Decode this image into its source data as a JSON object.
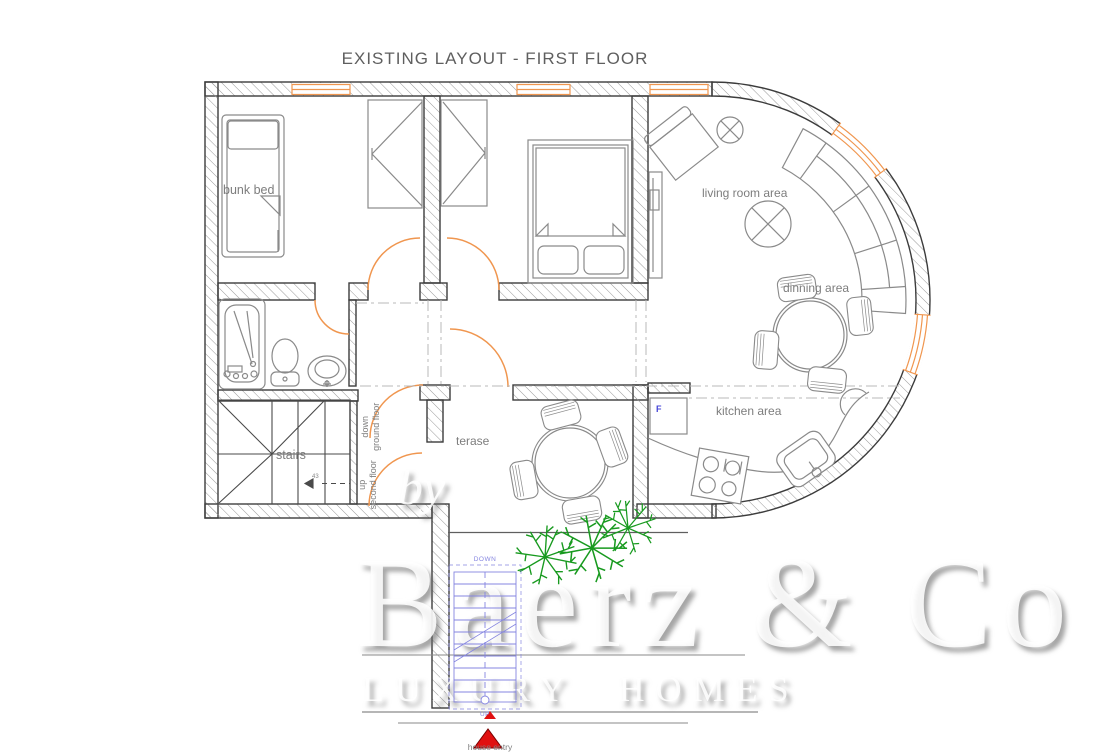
{
  "title": "EXISTING LAYOUT - FIRST FLOOR",
  "labels": {
    "bunk_bed": "bunk bed",
    "living_room": "living room area",
    "dining": "dinning area",
    "kitchen": "kitchen area",
    "terrace": "terase",
    "stairs": "stairs",
    "fridge": "F",
    "house_entry": "house entry"
  },
  "stair_notes": {
    "down": "down",
    "down_floor": "ground floor",
    "up": "up",
    "up_floor": "second floor",
    "steps": "43",
    "ext_down": "DOWN",
    "ext_up": "UP"
  },
  "watermark": {
    "by": "by",
    "brand": "Baerz & Co",
    "tagline": "LUXURY HOMES"
  },
  "colors": {
    "wall_line": "#3c3c3c",
    "hatch": "#9a9a9a",
    "furniture": "#8a8a8a",
    "door_window_orange": "#f0964f",
    "label_gray": "#7d7d7d",
    "plant_green": "#189a1f",
    "exterior_stair_blue": "#8585e0",
    "entry_red": "#e01010"
  }
}
